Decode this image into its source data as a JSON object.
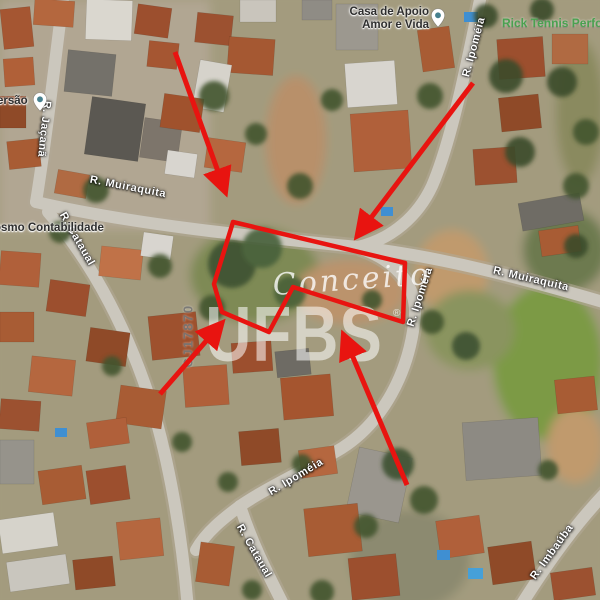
{
  "map": {
    "poi_labels": {
      "casa_line1": "Casa de Apoio",
      "casa_line2": "Amor e Vida",
      "rick_tennis": "Rick Tennis Perfor",
      "contabilidade": "osmo Contabilidade",
      "ersao": "ersão"
    },
    "street_labels": {
      "muiraquita_left": "R. Muiraquita",
      "muiraquita_right": "R. Muiraquita",
      "jacana": "R. Jaçanã",
      "ipomeia_top": "R. Ipoméia",
      "ipomeia_mid": "R. Ipoméia",
      "ipomeia_bottom": "R. Ipoméia",
      "cataual_left": "R. Cataual",
      "cataual_bottom": "R. Cataual",
      "imbauba": "R. Imbaúba"
    }
  },
  "watermarks": {
    "brand_script": "Conceito",
    "registered": "®",
    "agency": "UFBS",
    "code": "CJ17870"
  },
  "annotation": {
    "color": "#e81410",
    "polygon_points": "233,222 405,263 403,322 293,287 269,332 222,312 214,284",
    "arrows": {
      "top_left": "M 175,52 L 225,191",
      "top_right": "M 473,83 L 358,235",
      "bottom": "M 407,485 L 344,336",
      "left": "M 160,394 L 221,324"
    }
  },
  "colors": {
    "road": "#cbc7bd",
    "street_label_text": "#ffffff",
    "poi_label_text": "#2e2e2e",
    "poi_green": "#4aa14f",
    "pin_dot": "#47818f"
  }
}
